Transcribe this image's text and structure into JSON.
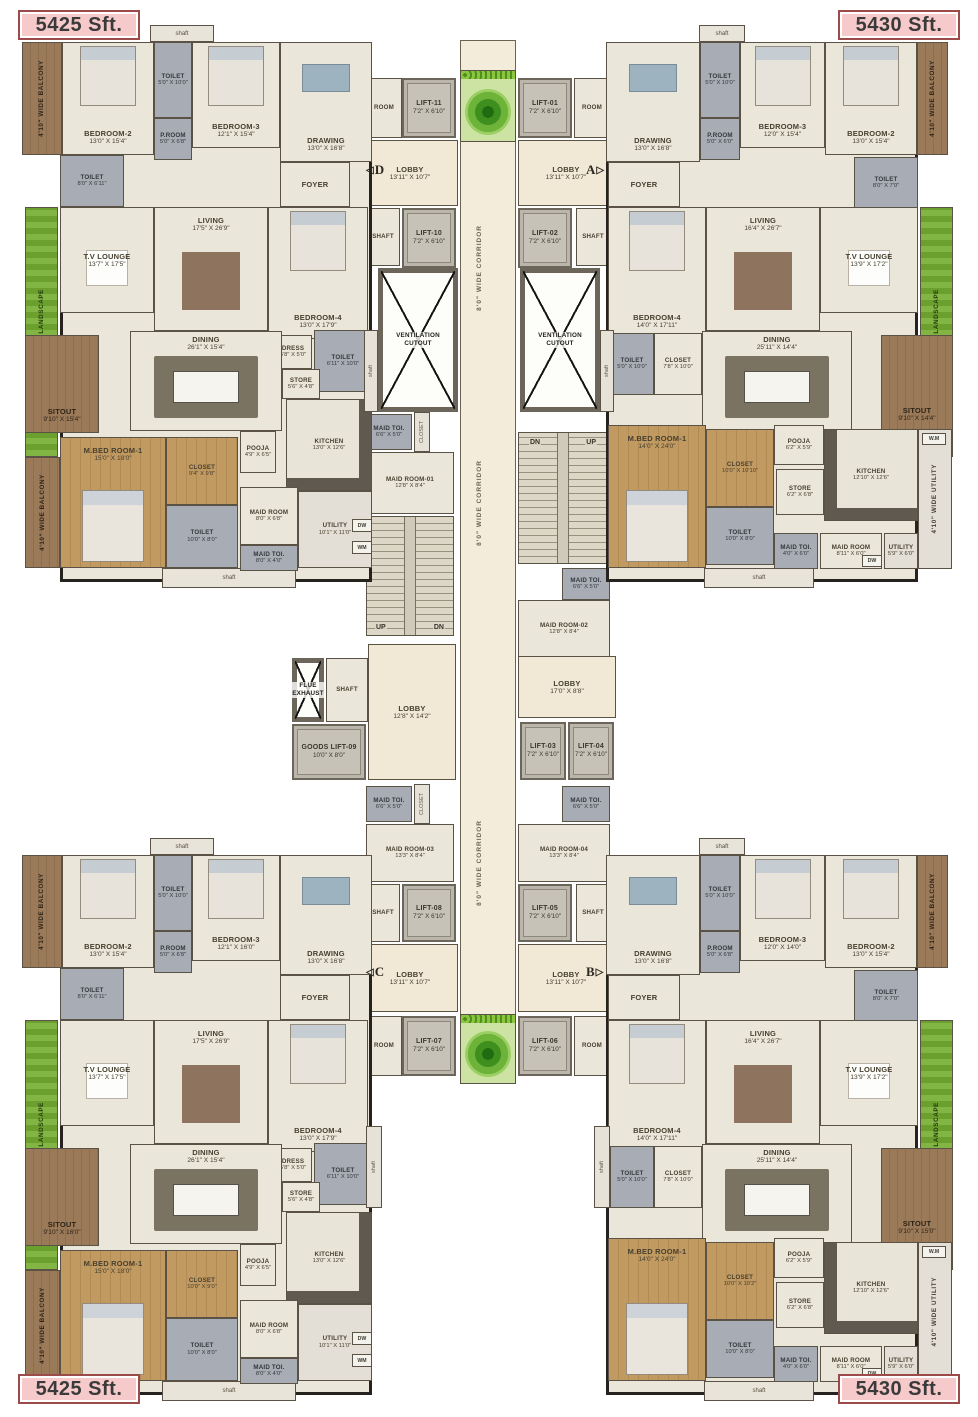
{
  "area_labels": {
    "tl": "5425 Sft.",
    "tr": "5430 Sft.",
    "bl": "5425 Sft.",
    "br": "5430 Sft."
  },
  "colors": {
    "label_bg": "#f6caca",
    "label_border": "#9c4a4a",
    "floor": "#ebe6da",
    "wall": "#26221d",
    "wet_gray": "#a8acb4",
    "wood": "#bb9059",
    "balcony_brown": "#96775b",
    "landscape_green": "#7db33e",
    "lift_gray": "#bab6ac"
  },
  "units": {
    "tl": {
      "shaft_top": "shaft",
      "shaft_bottom": "shaft",
      "balcony_top": "4'10\" WIDE BALCONY",
      "balcony_side": "4'10\" WIDE BALCONY",
      "landscape": "4'10\" WIDE LANDSCAPE",
      "bedroom2": {
        "n": "BEDROOM-2",
        "d": "13'0\" X 15'4\""
      },
      "toilet_a": {
        "n": "TOILET",
        "d": "5'0\" X 10'0\""
      },
      "p_room": {
        "n": "P.ROOM",
        "d": "5'0\" X 6'8\""
      },
      "bedroom3": {
        "n": "BEDROOM-3",
        "d": "12'1\" X 15'4\""
      },
      "drawing": {
        "n": "DRAWING",
        "d": "13'0\" X 16'8\""
      },
      "toilet_b": {
        "n": "TOILET",
        "d": "8'0\" X 6'11\""
      },
      "foyer": {
        "n": "FOYER",
        "d": ""
      },
      "tv_lounge": {
        "n": "T.V LOUNGE",
        "d": "13'7\" X 17'5\""
      },
      "living": {
        "n": "LIVING",
        "d": "17'5\" X 26'9\""
      },
      "bedroom4": {
        "n": "BEDROOM-4",
        "d": "13'0\" X 17'9\""
      },
      "dress": {
        "n": "DRESS",
        "d": "5'8\" X 5'0\""
      },
      "toilet_c": {
        "n": "TOILET",
        "d": "6'11\" X 10'0\""
      },
      "store": {
        "n": "STORE",
        "d": "5'6\" X 4'8\""
      },
      "dining": {
        "n": "DINING",
        "d": "26'1\" X 15'4\""
      },
      "sitout": {
        "n": "SITOUT",
        "d": "9'10\" X 15'4\""
      },
      "pooja": {
        "n": "POOJA",
        "d": "4'9\" X 6'5\""
      },
      "kitchen": {
        "n": "KITCHEN",
        "d": "13'0\" X 12'6\""
      },
      "m_bed": {
        "n": "M.BED ROOM-1",
        "d": "15'0\" X 18'0\""
      },
      "closet": {
        "n": "CLOSET",
        "d": "9'4\" X 9'8\""
      },
      "toilet_d": {
        "n": "TOILET",
        "d": "10'0\" X 8'0\""
      },
      "maid_room": {
        "n": "MAID ROOM",
        "d": "8'0\" X 6'8\""
      },
      "maid_toi": {
        "n": "MAID TOI.",
        "d": "8'0\" X 4'0\""
      },
      "utility": {
        "n": "UTILITY",
        "d": "10'1\" X 11'0\""
      },
      "dw": "DW",
      "wm": "WM"
    },
    "bl": {
      "shaft_top": "shaft",
      "shaft_bottom": "shaft",
      "balcony_top": "4'10\" WIDE BALCONY",
      "balcony_side": "4'10\" WIDE BALCONY",
      "landscape": "4'10\" WIDE LANDSCAPE",
      "bedroom2": {
        "n": "BEDROOM-2",
        "d": "13'0\" X 15'4\""
      },
      "toilet_a": {
        "n": "TOILET",
        "d": "5'0\" X 10'0\""
      },
      "p_room": {
        "n": "P.ROOM",
        "d": "5'0\" X 6'8\""
      },
      "bedroom3": {
        "n": "BEDROOM-3",
        "d": "12'1\" X 16'0\""
      },
      "drawing": {
        "n": "DRAWING",
        "d": "13'0\" X 16'8\""
      },
      "toilet_b": {
        "n": "TOILET",
        "d": "8'0\" X 6'11\""
      },
      "foyer": {
        "n": "FOYER",
        "d": ""
      },
      "tv_lounge": {
        "n": "T.V LOUNGE",
        "d": "13'7\" X 17'5\""
      },
      "living": {
        "n": "LIVING",
        "d": "17'5\" X 26'9\""
      },
      "bedroom4": {
        "n": "BEDROOM-4",
        "d": "13'0\" X 17'9\""
      },
      "dress": {
        "n": "DRESS",
        "d": "5'8\" X 5'0\""
      },
      "toilet_c": {
        "n": "TOILET",
        "d": "6'11\" X 10'0\""
      },
      "store": {
        "n": "STORE",
        "d": "5'6\" X 4'8\""
      },
      "dining": {
        "n": "DINING",
        "d": "26'1\" X 15'4\""
      },
      "sitout": {
        "n": "SITOUT",
        "d": "9'10\" X 16'0\""
      },
      "pooja": {
        "n": "POOJA",
        "d": "4'9\" X 6'5\""
      },
      "kitchen": {
        "n": "KITCHEN",
        "d": "13'0\" X 12'6\""
      },
      "m_bed": {
        "n": "M.BED ROOM-1",
        "d": "15'0\" X 18'0\""
      },
      "closet": {
        "n": "CLOSET",
        "d": "10'0\" X 9'0\""
      },
      "toilet_d": {
        "n": "TOILET",
        "d": "10'0\" X 8'0\""
      },
      "maid_room": {
        "n": "MAID ROOM",
        "d": "8'0\" X 6'8\""
      },
      "maid_toi": {
        "n": "MAID TOI.",
        "d": "8'0\" X 4'0\""
      },
      "utility": {
        "n": "UTILITY",
        "d": "10'1\" X 11'0\""
      },
      "dw": "DW",
      "wm": "WM"
    },
    "tr": {
      "shaft_top": "shaft",
      "shaft_bottom": "shaft",
      "balcony_top": "4'10\" WIDE BALCONY",
      "landscape": "4'10\" WIDE LANDSCAPE",
      "utility_strip": "4'10\" WIDE UTILITY",
      "bedroom2": {
        "n": "BEDROOM-2",
        "d": "13'0\" X 15'4\""
      },
      "toilet_a": {
        "n": "TOILET",
        "d": "5'0\" X 10'0\""
      },
      "p_room": {
        "n": "P.ROOM",
        "d": "5'0\" X 6'0\""
      },
      "bedroom3": {
        "n": "BEDROOM-3",
        "d": "12'0\" X 15'4\""
      },
      "drawing": {
        "n": "DRAWING",
        "d": "13'0\" X 16'8\""
      },
      "toilet_b": {
        "n": "TOILET",
        "d": "8'0\" X 7'0\""
      },
      "foyer": {
        "n": "FOYER",
        "d": ""
      },
      "tv_lounge": {
        "n": "T.V LOUNGE",
        "d": "13'9\" X 17'2\""
      },
      "living": {
        "n": "LIVING",
        "d": "16'4\" X 26'7\""
      },
      "bedroom4": {
        "n": "BEDROOM-4",
        "d": "14'0\" X 17'11\""
      },
      "toilet_c": {
        "n": "TOILET",
        "d": "5'0\" X 10'0\""
      },
      "closet_b": {
        "n": "CLOSET",
        "d": "7'8\" X 10'0\""
      },
      "dining": {
        "n": "DINING",
        "d": "25'11\" X 14'4\""
      },
      "sitout": {
        "n": "SITOUT",
        "d": "9'10\" X 14'4\""
      },
      "m_bed": {
        "n": "M.BED ROOM-1",
        "d": "14'0\" X 24'0\""
      },
      "closet": {
        "n": "CLOSET",
        "d": "10'0\" X 10'10\""
      },
      "pooja": {
        "n": "POOJA",
        "d": "6'2\" X 5'9\""
      },
      "store": {
        "n": "STORE",
        "d": "6'2\" X 6'8\""
      },
      "kitchen": {
        "n": "KITCHEN",
        "d": "12'10\" X 12'6\""
      },
      "toilet_d": {
        "n": "TOILET",
        "d": "10'0\" X 8'0\""
      },
      "maid_toi": {
        "n": "MAID TOI.",
        "d": "4'0\" X 6'0\""
      },
      "maid_room": {
        "n": "MAID ROOM",
        "d": "8'11\" X 6'0\""
      },
      "utility": {
        "n": "UTILITY",
        "d": "5'9\" X 6'0\""
      },
      "dw": "DW",
      "wm": "W.M"
    },
    "br": {
      "shaft_top": "shaft",
      "shaft_bottom": "shaft",
      "balcony_top": "4'10\" WIDE BALCONY",
      "landscape": "4'10\" WIDE LANDSCAPE",
      "utility_strip": "4'10\" WIDE UTILITY",
      "bedroom2": {
        "n": "BEDROOM-2",
        "d": "13'0\" X 15'4\""
      },
      "toilet_a": {
        "n": "TOILET",
        "d": "5'0\" X 10'0\""
      },
      "p_room": {
        "n": "P.ROOM",
        "d": "5'0\" X 6'8\""
      },
      "bedroom3": {
        "n": "BEDROOM-3",
        "d": "12'0\" X 14'0\""
      },
      "drawing": {
        "n": "DRAWING",
        "d": "13'0\" X 16'8\""
      },
      "toilet_b": {
        "n": "TOILET",
        "d": "8'0\" X 7'0\""
      },
      "foyer": {
        "n": "FOYER",
        "d": ""
      },
      "tv_lounge": {
        "n": "T.V LOUNGE",
        "d": "13'9\" X 17'2\""
      },
      "living": {
        "n": "LIVING",
        "d": "16'4\" X 26'7\""
      },
      "bedroom4": {
        "n": "BEDROOM-4",
        "d": "14'0\" X 17'11\""
      },
      "toilet_c": {
        "n": "TOILET",
        "d": "5'0\" X 10'0\""
      },
      "closet_b": {
        "n": "CLOSET",
        "d": "7'8\" X 10'0\""
      },
      "dining": {
        "n": "DINING",
        "d": "25'11\" X 14'4\""
      },
      "sitout": {
        "n": "SITOUT",
        "d": "9'10\" X 15'0\""
      },
      "m_bed": {
        "n": "M.BED ROOM-1",
        "d": "14'0\" X 24'0\""
      },
      "closet": {
        "n": "CLOSET",
        "d": "10'0\" X 10'2\""
      },
      "pooja": {
        "n": "POOJA",
        "d": "6'2\" X 5'9\""
      },
      "store": {
        "n": "STORE",
        "d": "6'2\" X 6'8\""
      },
      "kitchen": {
        "n": "KITCHEN",
        "d": "12'10\" X 12'6\""
      },
      "toilet_d": {
        "n": "TOILET",
        "d": "10'0\" X 8'0\""
      },
      "maid_toi": {
        "n": "MAID TOI.",
        "d": "4'0\" X 6'0\""
      },
      "maid_room": {
        "n": "MAID ROOM",
        "d": "8'11\" X 6'0\""
      },
      "utility": {
        "n": "UTILITY",
        "d": "5'9\" X 6'0\""
      },
      "dw": "DW",
      "wm": "W.M"
    }
  },
  "core": {
    "room": "ROOM",
    "corridor": "8'0\" WIDE CORRIDOR",
    "vent": "VENTILATION CUTOUT",
    "shaft": "SHAFT",
    "shaft_small": "shaft",
    "closet_small": "CLOSET",
    "flue": "FLUE EXHAUST",
    "up": "UP",
    "dn": "DN",
    "lift11": {
      "n": "LIFT-11",
      "d": "7'2\" X 6'10\""
    },
    "lift01": {
      "n": "LIFT-01",
      "d": "7'2\" X 6'10\""
    },
    "lift10": {
      "n": "LIFT-10",
      "d": "7'2\" X 6'10\""
    },
    "lift02": {
      "n": "LIFT-02",
      "d": "7'2\" X 6'10\""
    },
    "lift03": {
      "n": "LIFT-03",
      "d": "7'2\" X 6'10\""
    },
    "lift04": {
      "n": "LIFT-04",
      "d": "7'2\" X 6'10\""
    },
    "lift05": {
      "n": "LIFT-05",
      "d": "7'2\" X 6'10\""
    },
    "lift06": {
      "n": "LIFT-06",
      "d": "7'2\" X 6'10\""
    },
    "lift07": {
      "n": "LIFT-07",
      "d": "7'2\" X 6'10\""
    },
    "lift08": {
      "n": "LIFT-08",
      "d": "7'2\" X 6'10\""
    },
    "goods_lift": {
      "n": "GOODS LIFT-09",
      "d": "10'0\" X 8'0\""
    },
    "lobby_d": {
      "n": "LOBBY",
      "d": "13'11\" X 10'7\"",
      "m": "D"
    },
    "lobby_a": {
      "n": "LOBBY",
      "d": "13'11\" X 10'7\"",
      "m": "A"
    },
    "lobby_c": {
      "n": "LOBBY",
      "d": "13'11\" X 10'7\"",
      "m": "C"
    },
    "lobby_b": {
      "n": "LOBBY",
      "d": "13'11\" X 10'7\"",
      "m": "B"
    },
    "lobby_mid": {
      "n": "LOBBY",
      "d": "12'8\" X 14'2\""
    },
    "lobby_right": {
      "n": "LOBBY",
      "d": "17'0\" X 8'8\""
    },
    "maid_toi": {
      "n": "MAID TOI.",
      "d": "6'6\" X 5'0\""
    },
    "maid_room_01": {
      "n": "MAID ROOM-01",
      "d": "12'8\" X 8'4\""
    },
    "maid_room_02": {
      "n": "MAID ROOM-02",
      "d": "12'8\" X 8'4\""
    },
    "maid_room_03": {
      "n": "MAID ROOM-03",
      "d": "13'3\" X 8'4\""
    },
    "maid_room_04": {
      "n": "MAID ROOM-04",
      "d": "13'3\" X 8'4\""
    }
  }
}
